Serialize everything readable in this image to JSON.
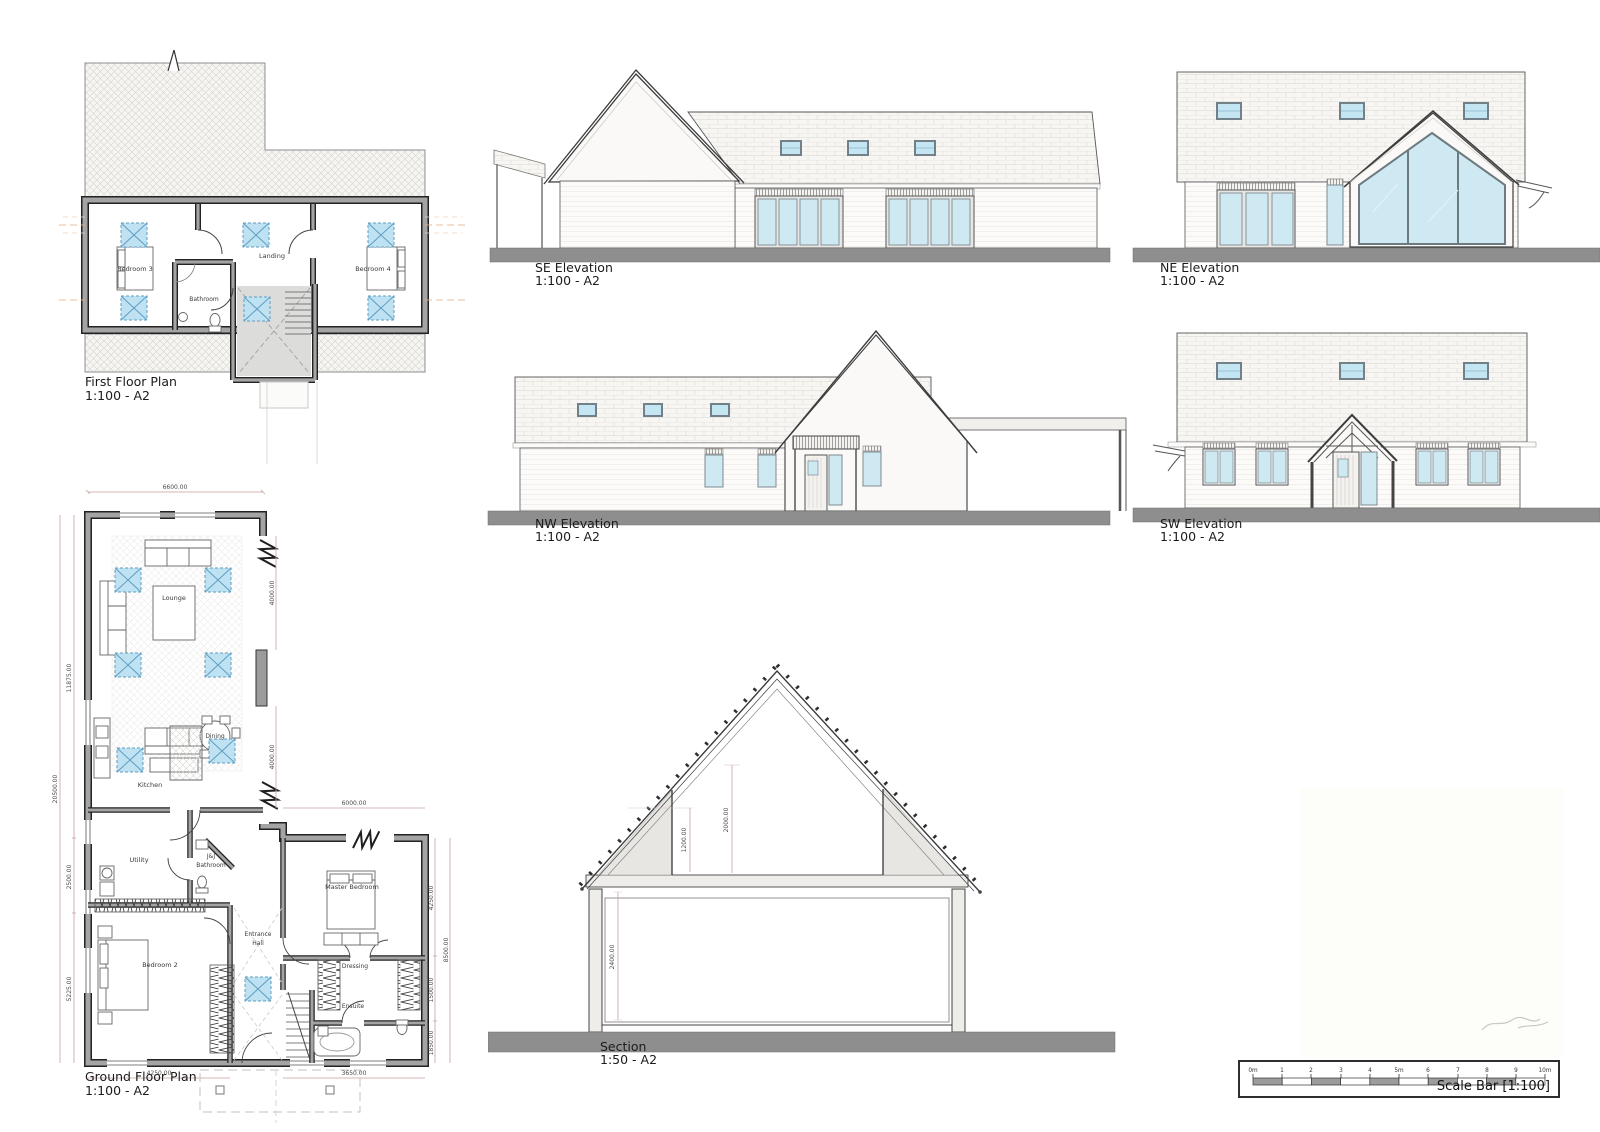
{
  "sheet": {
    "views": {
      "first_floor": {
        "title": "First Floor Plan",
        "scale": "1:100 - A2",
        "rooms": {
          "bedroom3": "Bedroom 3",
          "bathroom": "Bathroom",
          "landing": "Landing",
          "bedroom4": "Bedroom 4"
        }
      },
      "se": {
        "title": "SE Elevation",
        "scale": "1:100 - A2"
      },
      "ne": {
        "title": "NE Elevation",
        "scale": "1:100 - A2"
      },
      "nw": {
        "title": "NW Elevation",
        "scale": "1:100 - A2"
      },
      "sw": {
        "title": "SW Elevation",
        "scale": "1:100 - A2"
      },
      "ground_floor": {
        "title": "Ground Floor Plan",
        "scale": "1:100 - A2",
        "rooms": {
          "lounge": "Lounge",
          "dining": "Dining",
          "kitchen": "Kitchen",
          "utility": "Utility",
          "jj_bathroom_line1": "J&J",
          "jj_bathroom_line2": "Bathroom",
          "entrance_line1": "Entrance",
          "entrance_line2": "Hall",
          "bedroom2": "Bedroom 2",
          "master_bedroom": "Master Bedroom",
          "dressing": "Dressing",
          "ensuite": "Ensuite"
        },
        "dims": {
          "top": "6600.00",
          "left_outer": "20500.00",
          "left_upper": "11875.00",
          "left_mid": "2500.00",
          "left_lower": "5225.00",
          "lounge_right_upper": "4000.00",
          "lounge_right_lower": "4000.00",
          "master_top": "6000.00",
          "master_right": "4250.00",
          "dressing_right": "1500.00",
          "ensuite_right": "1850.00",
          "right_outer": "8500.00",
          "bottom_left": "4250.00",
          "bottom_right": "3650.00"
        }
      },
      "section": {
        "title": "Section",
        "scale": "1:50 - A2",
        "dims": {
          "attic_inner": "1200.00",
          "attic_full": "2000.00",
          "ground_floor": "2400.00"
        }
      },
      "scale_bar": {
        "label": "Scale Bar [1:100]",
        "ticks": [
          "0m",
          "1",
          "2",
          "3",
          "4",
          "5m",
          "6",
          "7",
          "8",
          "9",
          "10m"
        ]
      }
    }
  }
}
